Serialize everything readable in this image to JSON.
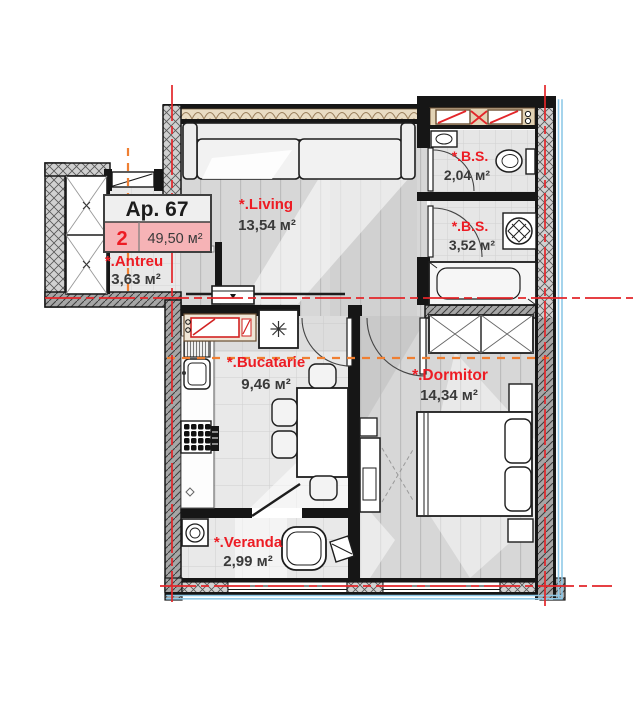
{
  "apartment": {
    "number_label": "Ap. 67",
    "rooms_badge": "2",
    "total_area": "49,50 м²"
  },
  "rooms": [
    {
      "name": "*.Antreu",
      "area": "3,63 м²"
    },
    {
      "name": "*.Living",
      "area": "13,54 м²"
    },
    {
      "name": "*.B.S.",
      "area": "2,04 м²"
    },
    {
      "name": "*.B.S.",
      "area": "3,52 м²"
    },
    {
      "name": "*.Bucatarie",
      "area": "9,46 м²"
    },
    {
      "name": "*.Dormitor",
      "area": "14,34 м²"
    },
    {
      "name": "*.Veranda",
      "area": "2,99 м²"
    }
  ],
  "colors": {
    "accent_red": "#ed1c24",
    "badge_pink": "#f6b3b6",
    "axis_orange": "#ef7f32",
    "glazing_blue": "#8fc9e8",
    "wall_dark": "#161616",
    "insulation_tan": "#e2d2b4"
  }
}
